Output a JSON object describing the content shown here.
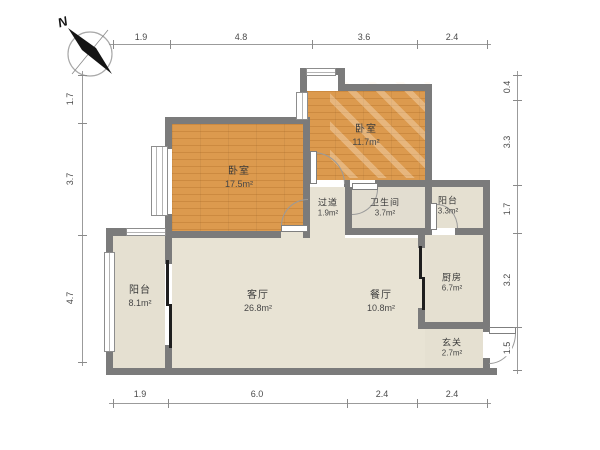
{
  "compass": {
    "north_label": "N"
  },
  "dimensions": {
    "top": [
      "1.9",
      "4.8",
      "3.6",
      "2.4"
    ],
    "bottom": [
      "1.9",
      "6.0",
      "2.4",
      "2.4"
    ],
    "left": [
      "1.7",
      "3.7",
      "4.7"
    ],
    "right": [
      "0.4",
      "3.3",
      "1.7",
      "3.2",
      "1.5"
    ]
  },
  "rooms": {
    "bedroom_left": {
      "name": "卧室",
      "area": "17.5m²"
    },
    "bedroom_top": {
      "name": "卧室",
      "area": "11.7m²"
    },
    "corridor": {
      "name": "过道",
      "area": "1.9m²"
    },
    "bathroom": {
      "name": "卫生间",
      "area": "3.7m²"
    },
    "balcony_small": {
      "name": "阳台",
      "area": "3.3m²"
    },
    "kitchen": {
      "name": "厨房",
      "area": "6.7m²"
    },
    "foyer": {
      "name": "玄关",
      "area": "2.7m²"
    },
    "dining": {
      "name": "餐厅",
      "area": "10.8m²"
    },
    "living": {
      "name": "客厅",
      "area": "26.8m²"
    },
    "balcony_large": {
      "name": "阳台",
      "area": "8.1m²"
    }
  },
  "colors": {
    "wall": "#7b7b7b",
    "wood_floor": "#dc9a4e",
    "tile_floor": "#e8e3d4",
    "dimension_line": "#9b9b9b"
  }
}
